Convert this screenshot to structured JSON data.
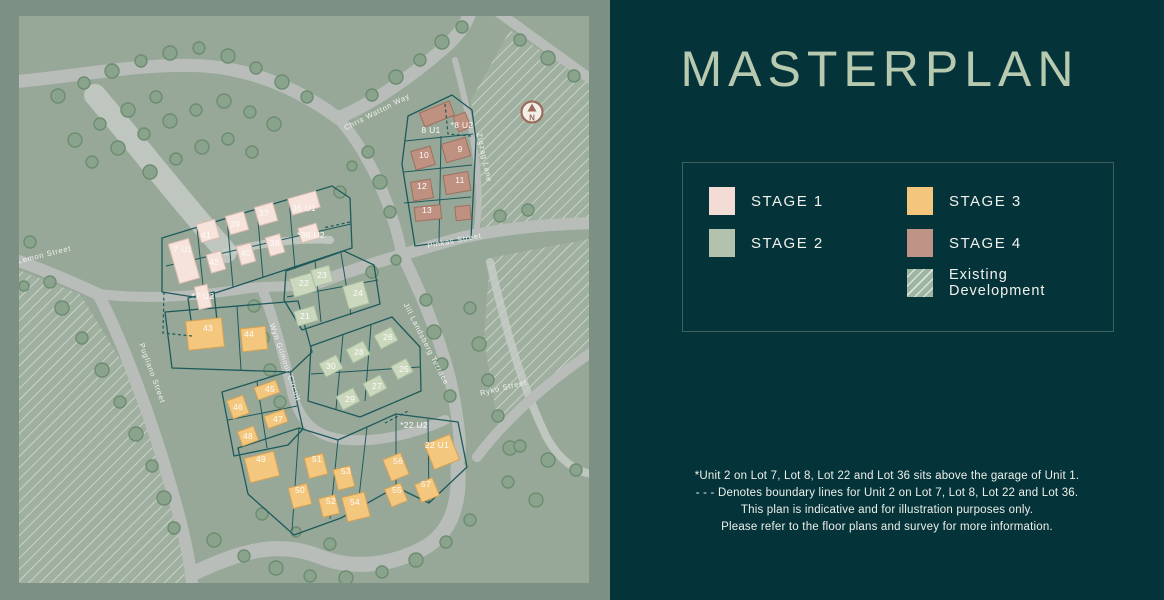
{
  "panel": {
    "title": "MASTERPLAN",
    "legend": {
      "items": [
        {
          "label": "STAGE 1",
          "color": "#f2dcd5"
        },
        {
          "label": "STAGE 2",
          "color": "#b2c2ac"
        },
        {
          "label": "STAGE 3",
          "color": "#f3c57d"
        },
        {
          "label": "STAGE 4",
          "color": "#bf9487"
        },
        {
          "label": "Existing Development",
          "color": "#9fb5a3",
          "hatched": true
        }
      ]
    },
    "footnotes": [
      "*Unit 2 on Lot 7, Lot 8, Lot 22 and Lot 36 sits above the garage of Unit 1.",
      "- - - Denotes boundary lines for Unit 2 on Lot 7, Lot 8, Lot 22 and Lot 36.",
      "This plan is indicative and for illustration purposes only.",
      "Please refer to the floor plans and survey for more information."
    ]
  },
  "map": {
    "compass": "N",
    "streets": [
      "Lemon Street",
      "Chris Watton Way",
      "Zigzag Lane",
      "Pinkas Street",
      "Jill Landsberg Terrace",
      "Ryko Street",
      "Pugliano Street",
      "Wyn Gilmour Circuit"
    ],
    "lots": [
      {
        "label": "8 U1",
        "stage": "4"
      },
      {
        "label": "*8 U2",
        "stage": "4"
      },
      {
        "label": "10",
        "stage": "4"
      },
      {
        "label": "9",
        "stage": "4"
      },
      {
        "label": "12",
        "stage": "4"
      },
      {
        "label": "11",
        "stage": "4"
      },
      {
        "label": "13",
        "stage": "4"
      },
      {
        "label": "7 U1",
        "stage": "1"
      },
      {
        "label": "41",
        "stage": "1"
      },
      {
        "label": "42",
        "stage": "1"
      },
      {
        "label": "39",
        "stage": "1"
      },
      {
        "label": "40",
        "stage": "1"
      },
      {
        "label": "37",
        "stage": "1"
      },
      {
        "label": "38",
        "stage": "1"
      },
      {
        "label": "36 U1",
        "stage": "1"
      },
      {
        "label": "*36 U2",
        "stage": "1"
      },
      {
        "label": "*7 U2",
        "stage": "1"
      },
      {
        "label": "22",
        "stage": "2"
      },
      {
        "label": "23",
        "stage": "2"
      },
      {
        "label": "24",
        "stage": "2"
      },
      {
        "label": "21",
        "stage": "2"
      },
      {
        "label": "26",
        "stage": "2"
      },
      {
        "label": "28",
        "stage": "2"
      },
      {
        "label": "30",
        "stage": "2"
      },
      {
        "label": "25",
        "stage": "2"
      },
      {
        "label": "27",
        "stage": "2"
      },
      {
        "label": "29",
        "stage": "2"
      },
      {
        "label": "43",
        "stage": "3"
      },
      {
        "label": "44",
        "stage": "3"
      },
      {
        "label": "45",
        "stage": "3"
      },
      {
        "label": "46",
        "stage": "3"
      },
      {
        "label": "47",
        "stage": "3"
      },
      {
        "label": "48",
        "stage": "3"
      },
      {
        "label": "49",
        "stage": "3"
      },
      {
        "label": "50",
        "stage": "3"
      },
      {
        "label": "51",
        "stage": "3"
      },
      {
        "label": "52",
        "stage": "3"
      },
      {
        "label": "53",
        "stage": "3"
      },
      {
        "label": "54",
        "stage": "3"
      },
      {
        "label": "55",
        "stage": "3"
      },
      {
        "label": "56",
        "stage": "3"
      },
      {
        "label": "57",
        "stage": "3"
      },
      {
        "label": "22 U1",
        "stage": "3"
      },
      {
        "label": "*22 U2",
        "stage": "3"
      }
    ]
  },
  "colors": {
    "panel_bg": "#04333a",
    "frame": "#7c9183",
    "map_bg": "#97a898",
    "road": "#b9bdba",
    "lot_line": "#1e5a5b",
    "title": "#b7c9ae",
    "text": "#f2f2ec"
  }
}
